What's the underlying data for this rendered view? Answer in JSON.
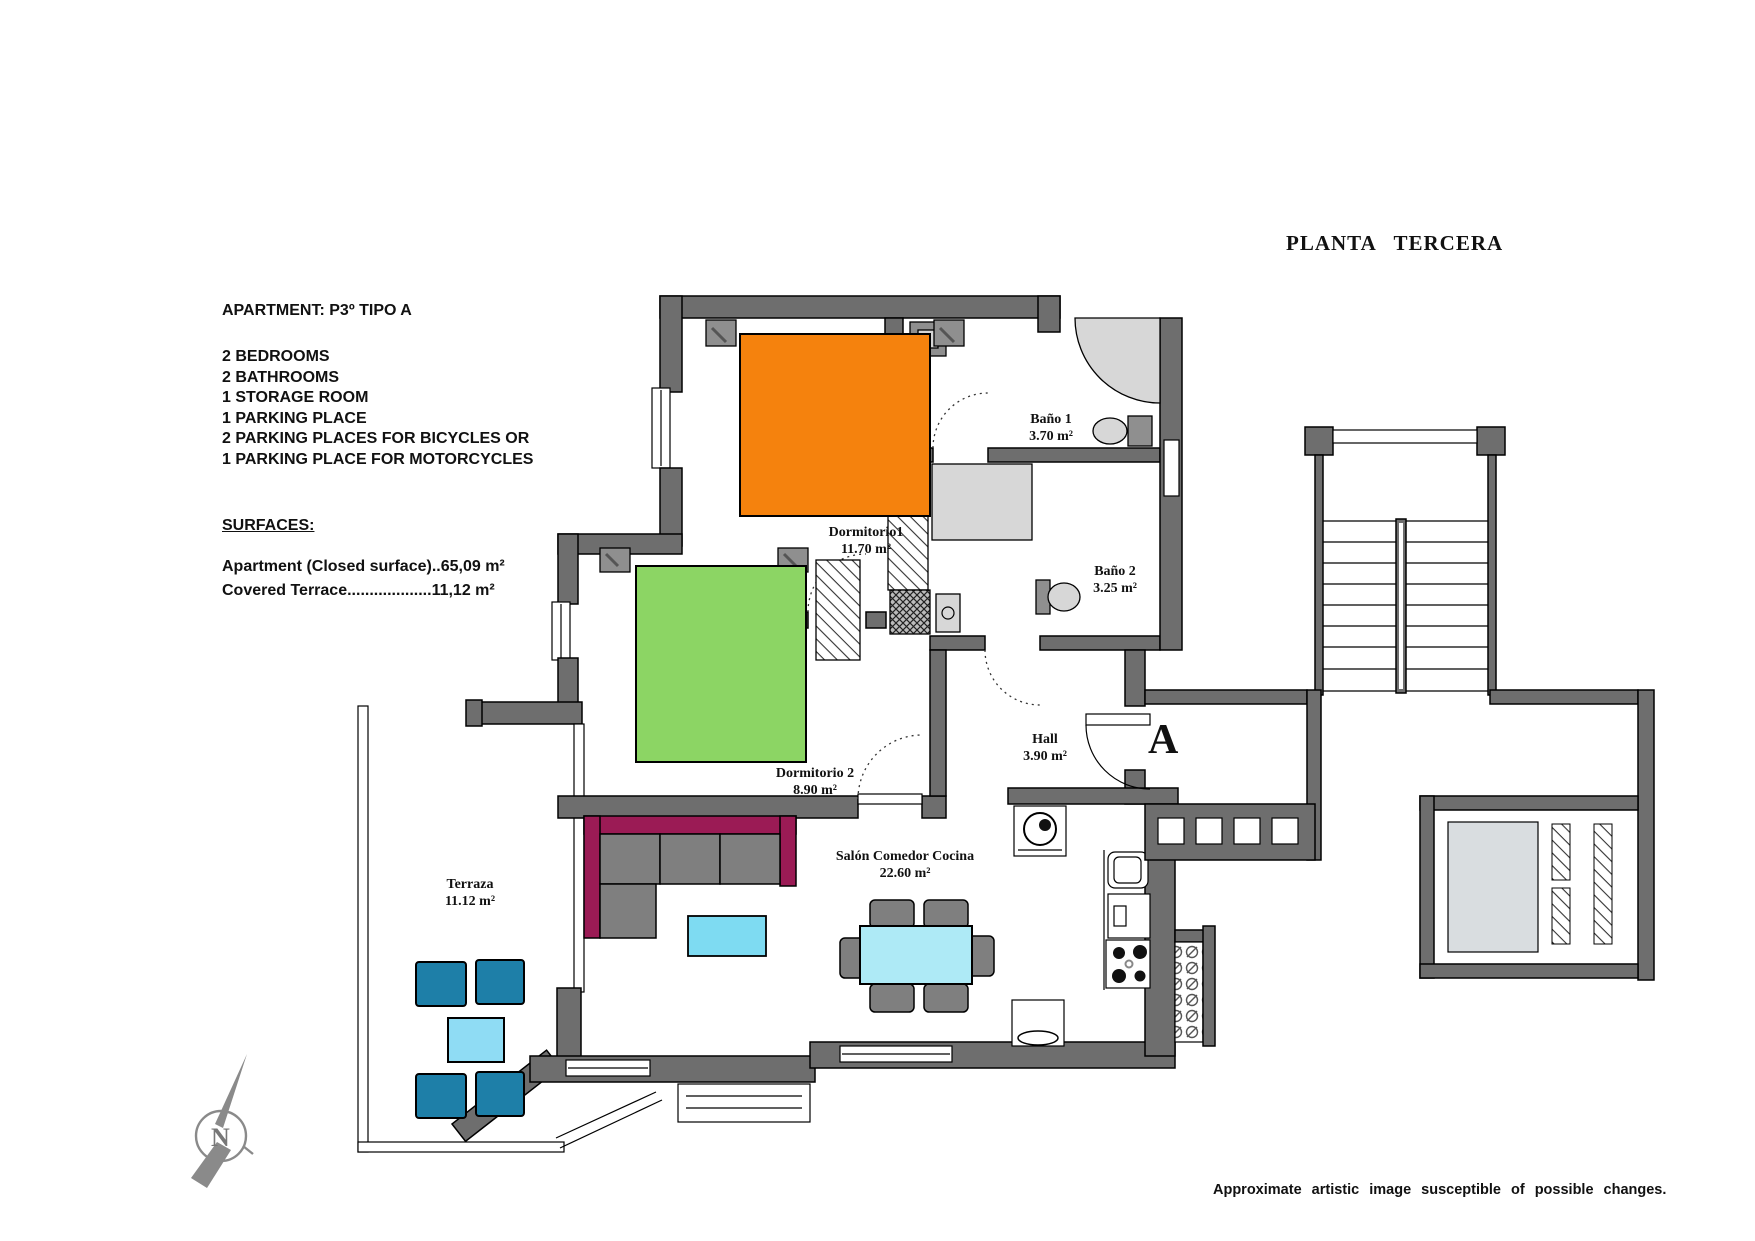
{
  "title": "PLANTA TERCERA",
  "info": {
    "apartment": "APARTMENT: P3º TIPO A",
    "features": [
      "2 BEDROOMS",
      "2 BATHROOMS",
      "1 STORAGE ROOM",
      "1 PARKING PLACE",
      "2 PARKING PLACES FOR BICYCLES OR",
      "1 PARKING PLACE FOR MOTORCYCLES"
    ],
    "surfaces_heading": "SURFACES:",
    "surfaces": [
      "Apartment (Closed surface)..65,09 m²",
      "Covered Terrace...................11,12 m²"
    ]
  },
  "rooms": [
    {
      "name": "Dormitorio1",
      "area": "11.70 m²"
    },
    {
      "name": "Baño 1",
      "area": "3.70 m²"
    },
    {
      "name": "Baño 2",
      "area": "3.25 m²"
    },
    {
      "name": "Dormitorio 2",
      "area": "8.90 m²"
    },
    {
      "name": "Hall",
      "area": "3.90 m²"
    },
    {
      "name": "Salón Comedor Cocina",
      "area": "22.60 m²"
    },
    {
      "name": "Terraza",
      "area": "11.12 m²"
    }
  ],
  "section_label": "A",
  "compass_label": "N",
  "footer_note": "Approximate artistic image susceptible of possible changes.",
  "colors": {
    "wall": "#6e6e6e",
    "fixture": "#d7d7d7",
    "bed_orange": "#F5820D",
    "bed_green": "#8CD564",
    "sofa": "#9B1B55",
    "cushion": "#7f7f7f",
    "coffee": "#7EDBF2",
    "dining": "#AEEAF6",
    "terrace_chair": "#1E7FA8",
    "terrace_table": "#8FDCF4"
  }
}
